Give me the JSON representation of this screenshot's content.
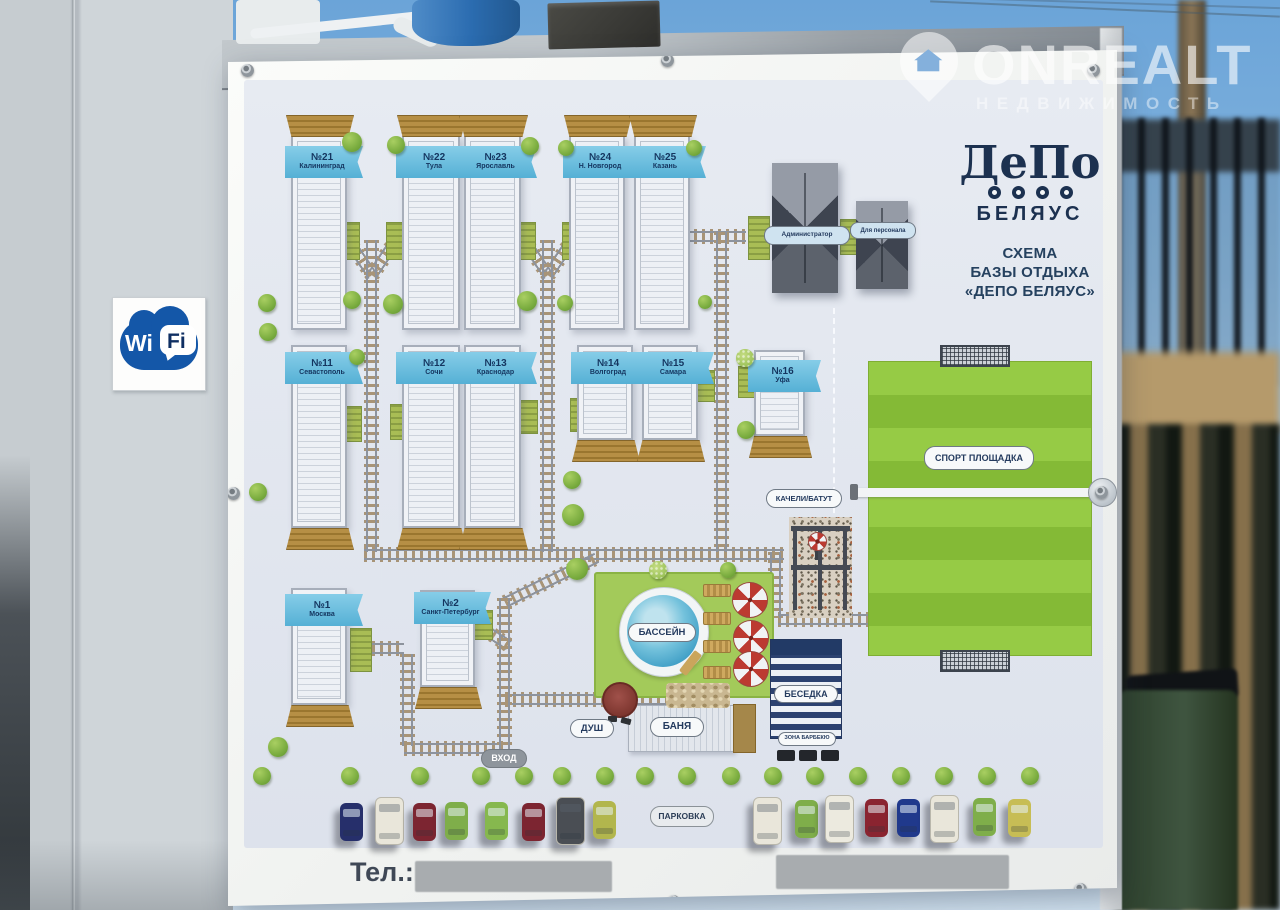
{
  "watermark": {
    "brand": "ONREALT",
    "tagline": "НЕДВИЖИМОСТЬ"
  },
  "wifi_sign": {
    "wi": "Wi",
    "fi": "Fi"
  },
  "logo": {
    "train_text": "ДеПо",
    "name": "БЕЛЯУС"
  },
  "scheme_title": {
    "line1": "СХЕМА",
    "line2": "БАЗЫ ОТДЫХА",
    "line3": "«ДЕПО БЕЛЯУС»"
  },
  "houses": {
    "top_row": [
      {
        "num": "№21",
        "city": "Калининград"
      },
      {
        "num": "№22",
        "city": "Тула"
      },
      {
        "num": "№23",
        "city": "Ярославль"
      },
      {
        "num": "№24",
        "city": "Н. Новгород"
      },
      {
        "num": "№25",
        "city": "Казань"
      }
    ],
    "middle_row": [
      {
        "num": "№11",
        "city": "Севастополь"
      },
      {
        "num": "№12",
        "city": "Сочи"
      },
      {
        "num": "№13",
        "city": "Краснодар"
      },
      {
        "num": "№14",
        "city": "Волгоград"
      },
      {
        "num": "№15",
        "city": "Самара"
      },
      {
        "num": "№16",
        "city": "Уфа"
      }
    ],
    "bottom_row": [
      {
        "num": "№1",
        "city": "Москва"
      },
      {
        "num": "№2",
        "city": "Санкт-Петербург"
      }
    ]
  },
  "service_buildings": {
    "admin": "Администратор",
    "staff": "Для персонала"
  },
  "areas": {
    "sport": "СПОРТ ПЛОЩАДКА",
    "swings": "КАЧЕЛИ/БАТУТ",
    "pool": "БАССЕЙН",
    "gazebo": "БЕСЕДКА",
    "bbq": "ЗОНА БАРБЕКЮ",
    "shower": "ДУШ",
    "sauna": "БАНЯ",
    "entrance": "ВХОД",
    "parking": "ПАРКОВКА"
  },
  "phone": {
    "label": "Тел.:"
  },
  "parking_cars": {
    "left": [
      {
        "type": "car",
        "color": "#262f6b"
      },
      {
        "type": "van",
        "color": "#e9e6da"
      },
      {
        "type": "car",
        "color": "#7c2531"
      },
      {
        "type": "car",
        "color": "#7fae4a"
      },
      {
        "type": "car",
        "color": "#86b84e"
      },
      {
        "type": "car",
        "color": "#7c2531"
      },
      {
        "type": "van",
        "color": "#4a4e54"
      },
      {
        "type": "car",
        "color": "#b2b64d"
      }
    ],
    "right": [
      {
        "type": "van",
        "color": "#e9e6da"
      },
      {
        "type": "car",
        "color": "#7fae4a"
      },
      {
        "type": "van",
        "color": "#eceadf"
      },
      {
        "type": "car",
        "color": "#8a2430"
      },
      {
        "type": "car",
        "color": "#20398c"
      },
      {
        "type": "van",
        "color": "#e9e6da"
      },
      {
        "type": "car",
        "color": "#7fae4a"
      },
      {
        "type": "car",
        "color": "#c7bd55"
      }
    ]
  },
  "colors": {
    "banner": "#f5f6f4",
    "map_bg": "#e3e7ef",
    "flag_blue": "#5fb6d8",
    "field_green": "#8fc542",
    "lawn_green": "#a3ca5a",
    "pool_blue": "#4aa6cc",
    "gazebo_navy": "#2c4270",
    "track_tie": "#a89477",
    "wifi_blue": "#1457a8"
  }
}
